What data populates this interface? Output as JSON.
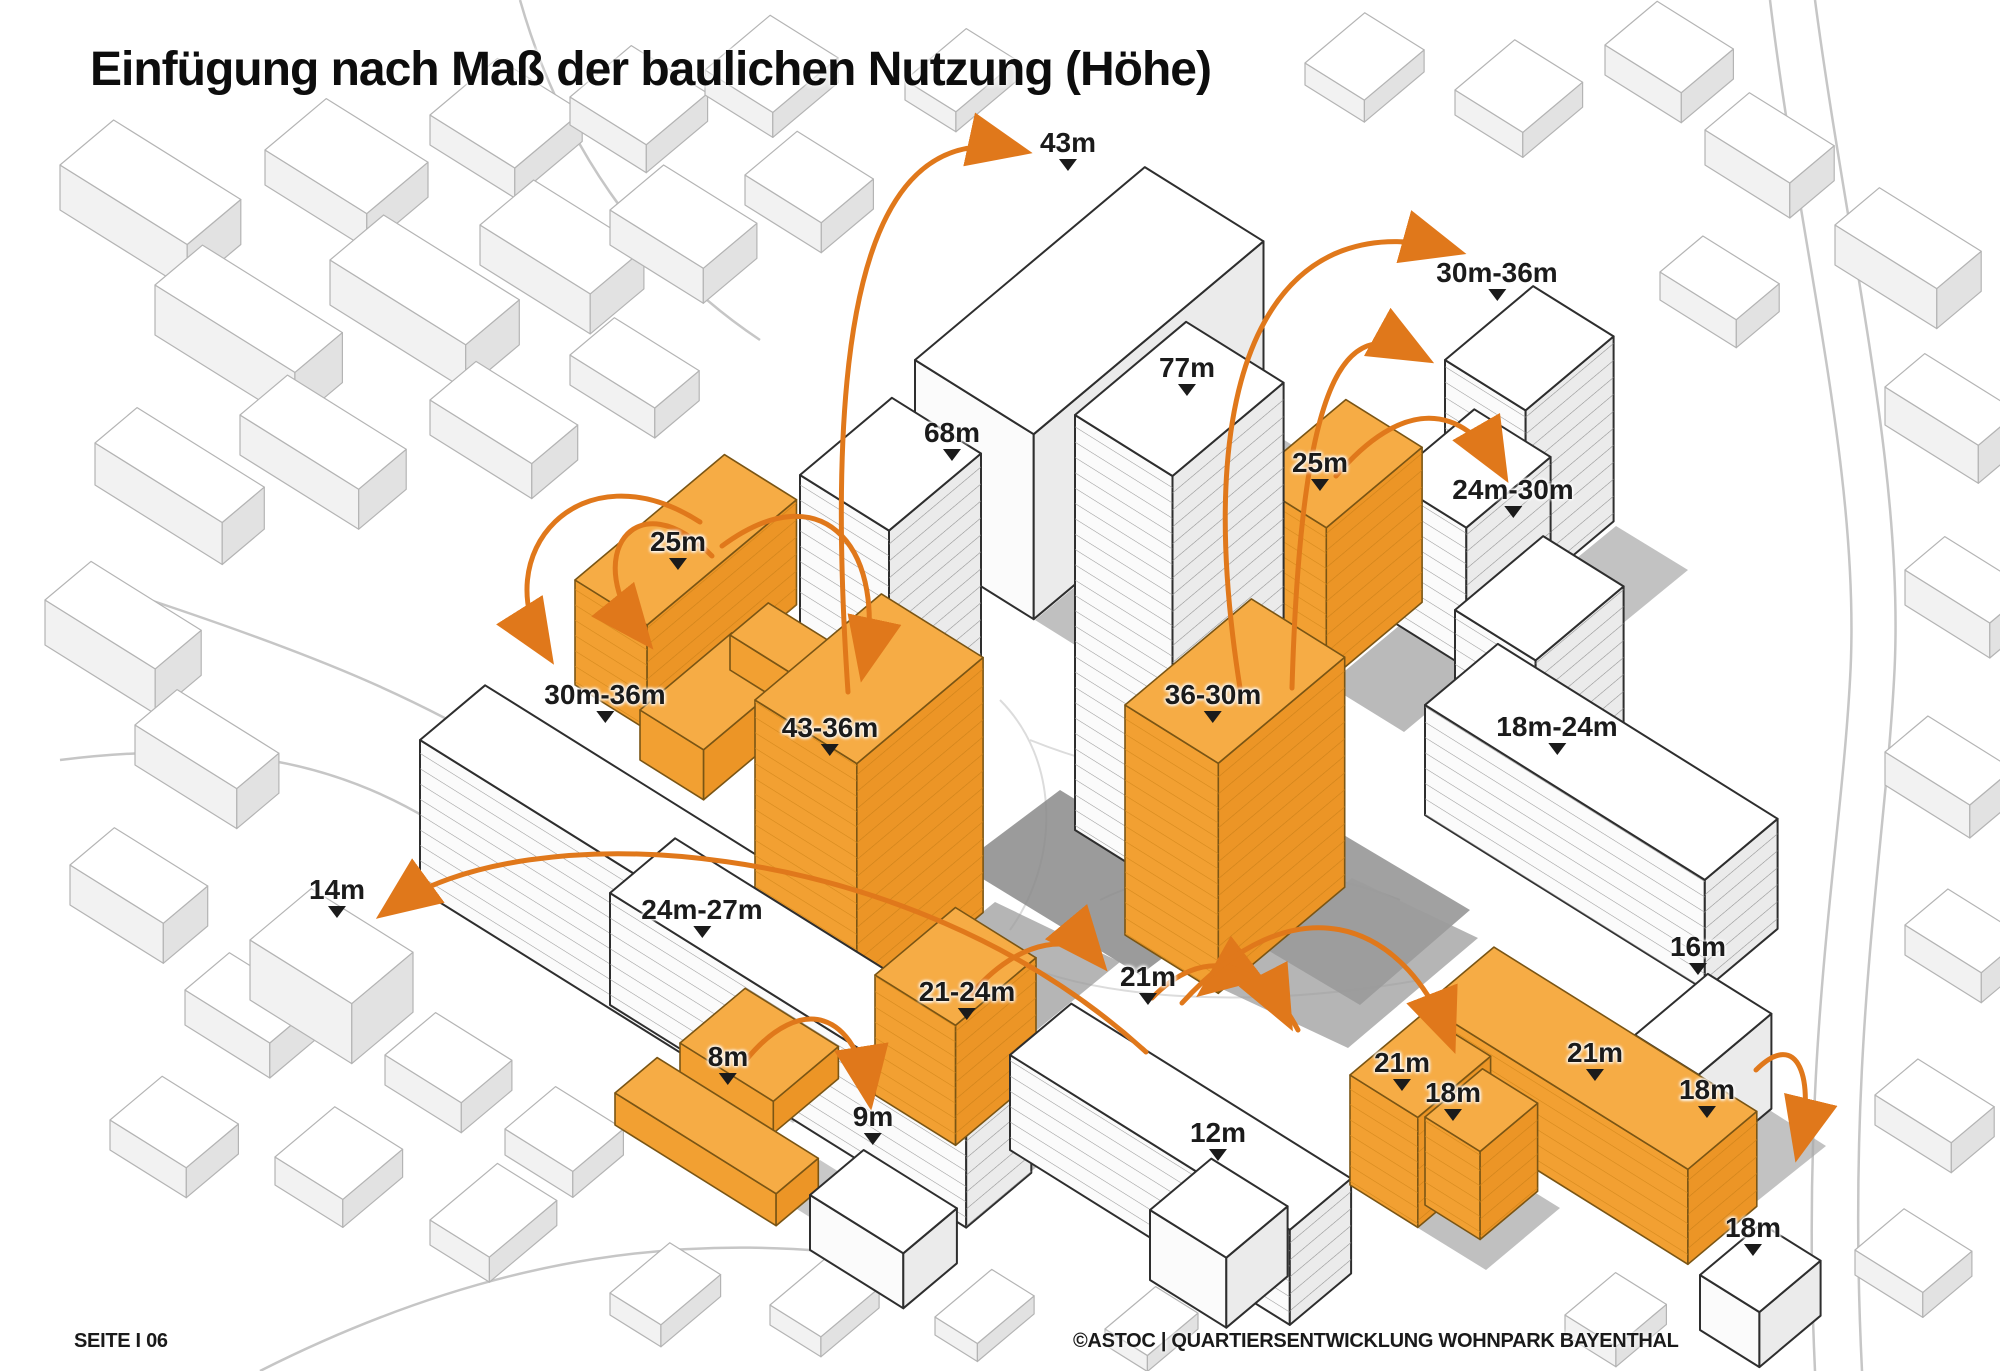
{
  "title": "Einfügung nach Maß der baulichen Nutzung (Höhe)",
  "footer": {
    "page": "SEITE I 06",
    "credit": "©ASTOC | QUARTIERSENTWICKLUNG WOHNPARK BAYENTHAL"
  },
  "colors": {
    "highlight_top": "#F6AC45",
    "highlight_face": "#F2A032",
    "highlight_face_dark": "#EC9526",
    "arrow": "#E0781B",
    "label_text": "#1b1b1b",
    "existing_building": "#ffffff",
    "shadow": "#9c9c9c"
  },
  "legend_meaning": {
    "orange_buildings": "neue Baukörper (geplant)",
    "white_buildings": "Bestand",
    "labels": "Gebäudehöhen"
  },
  "labels": [
    {
      "text": "43m",
      "x": 1068,
      "y": 128
    },
    {
      "text": "68m",
      "x": 952,
      "y": 418
    },
    {
      "text": "77m",
      "x": 1187,
      "y": 353
    },
    {
      "text": "30m-36m",
      "x": 1497,
      "y": 258
    },
    {
      "text": "25m",
      "x": 1320,
      "y": 448
    },
    {
      "text": "24m-30m",
      "x": 1513,
      "y": 475
    },
    {
      "text": "25m",
      "x": 678,
      "y": 527
    },
    {
      "text": "30m-36m",
      "x": 605,
      "y": 680
    },
    {
      "text": "43-36m",
      "x": 830,
      "y": 713
    },
    {
      "text": "36-30m",
      "x": 1213,
      "y": 680
    },
    {
      "text": "18m-24m",
      "x": 1557,
      "y": 712
    },
    {
      "text": "14m",
      "x": 337,
      "y": 875
    },
    {
      "text": "24m-27m",
      "x": 702,
      "y": 895
    },
    {
      "text": "16m",
      "x": 1698,
      "y": 932
    },
    {
      "text": "21-24m",
      "x": 967,
      "y": 977
    },
    {
      "text": "21m",
      "x": 1148,
      "y": 962
    },
    {
      "text": "8m",
      "x": 728,
      "y": 1042
    },
    {
      "text": "9m",
      "x": 873,
      "y": 1102
    },
    {
      "text": "12m",
      "x": 1218,
      "y": 1118
    },
    {
      "text": "21m",
      "x": 1402,
      "y": 1048
    },
    {
      "text": "18m",
      "x": 1453,
      "y": 1078
    },
    {
      "text": "21m",
      "x": 1595,
      "y": 1038
    },
    {
      "text": "18m",
      "x": 1707,
      "y": 1075
    },
    {
      "text": "18m",
      "x": 1753,
      "y": 1213
    }
  ]
}
